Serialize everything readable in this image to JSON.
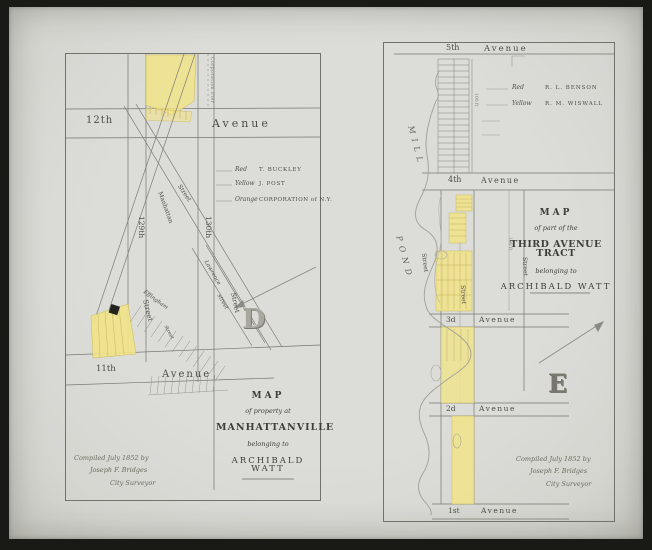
{
  "colors": {
    "paper": "#d8d8d3",
    "ink_line": "#77776f",
    "parcel_yellow": "#f1e388",
    "hatch_yellow": "#c9b957",
    "pond_line": "#a0a098"
  },
  "left_panel": {
    "plate_letter": "D",
    "pier_label": "Corporation Pier",
    "avenue_top": {
      "number": "12th",
      "word": "Avenue"
    },
    "avenue_bottom": {
      "number": "11th",
      "word": "Avenue"
    },
    "street_labels": {
      "s129": "129th",
      "s130": "130th",
      "manhattan": "Manhattan",
      "manhattan_word": "Street",
      "lawrence": "Lawrence",
      "lawrence_word": "street",
      "effingham": "Effingham",
      "street_a": "Street",
      "street_b": "street",
      "street_c": "Street"
    },
    "legend": {
      "rows": [
        {
          "color": "Red",
          "name": "T. BUCKLEY"
        },
        {
          "color": "Yellow",
          "name": "J. POST"
        },
        {
          "color": "Orange",
          "name": "CORPORATION of N.Y."
        }
      ]
    },
    "title": {
      "l1": "MAP",
      "l2": "of property at",
      "l3": "MANHATTANVILLE",
      "l4": "belonging to",
      "l5": "ARCHIBALD WATT"
    },
    "credit": {
      "l1": "Compiled July 1852 by",
      "l2": "Joseph F. Bridges",
      "l3": "City Surveyor"
    }
  },
  "right_panel": {
    "plate_letter": "E",
    "mill_pond": {
      "word1": "MILL",
      "word2": "POND"
    },
    "avenues": [
      {
        "number": "5th",
        "word": "Avenue"
      },
      {
        "number": "4th",
        "word": "Avenue"
      },
      {
        "number": "3d",
        "word": "Avenue"
      },
      {
        "number": "2d",
        "word": "Avenue"
      },
      {
        "number": "1st",
        "word": "Avenue"
      }
    ],
    "street_labels": {
      "a": "Street",
      "b": "Street",
      "c": "Street",
      "dim1": "100 ft",
      "dim2": "100 ft"
    },
    "legend": {
      "rows": [
        {
          "color": "Red",
          "name": "R. L. BENSON"
        },
        {
          "color": "Yellow",
          "name": "R. M. WISWALL"
        }
      ]
    },
    "title": {
      "l1": "MAP",
      "l2": "of part of the",
      "l3": "THIRD AVENUE TRACT",
      "l4": "belonging to",
      "l5": "ARCHIBALD WATT"
    },
    "credit": {
      "l1": "Compiled July 1852 by",
      "l2": "Joseph F. Bridges",
      "l3": "City Surveyor"
    }
  }
}
